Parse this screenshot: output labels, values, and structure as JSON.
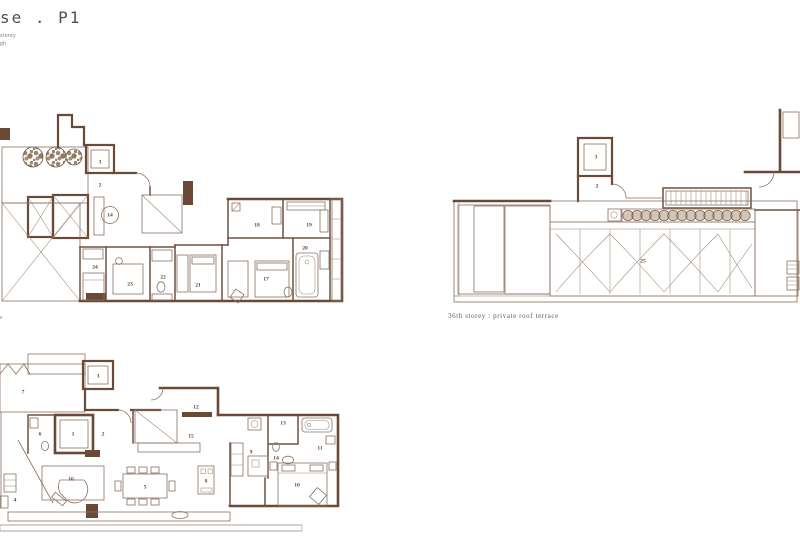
{
  "page": {
    "title_fragment": "se . P1",
    "subtitle_fragment_1": "storey",
    "subtitle_fragment_2": "gh",
    "left_caption_fragment": "e"
  },
  "colors": {
    "wall": "#6a4a37",
    "thin_line": "#8a7160",
    "hatch": "#a28a75",
    "foliage": "#7a5f47",
    "label_text": "#5f4434",
    "title_text": "#4f4f4f",
    "caption_text": "#6b5a4c",
    "background": "#ffffff"
  },
  "plans": {
    "upper_left": {
      "description": "penthouse upper storey floor plan",
      "labels": [
        {
          "x": 100,
          "y": 67,
          "t": "3"
        },
        {
          "x": 100,
          "y": 90,
          "t": "2"
        },
        {
          "x": 110,
          "y": 120,
          "t": "14"
        },
        {
          "x": 95,
          "y": 172,
          "t": "24"
        },
        {
          "x": 130,
          "y": 189,
          "t": "23"
        },
        {
          "x": 163,
          "y": 182,
          "t": "22"
        },
        {
          "x": 198,
          "y": 190,
          "t": "21"
        },
        {
          "x": 266,
          "y": 184,
          "t": "17"
        },
        {
          "x": 257,
          "y": 130,
          "t": "18"
        },
        {
          "x": 309,
          "y": 130,
          "t": "19"
        },
        {
          "x": 305,
          "y": 153,
          "t": "20"
        }
      ]
    },
    "roof": {
      "caption": "36th storey : private roof terrace",
      "labels": [
        {
          "x": 146,
          "y": 51,
          "t": "3"
        },
        {
          "x": 147,
          "y": 80,
          "t": "2"
        },
        {
          "x": 193,
          "y": 155,
          "t": "25"
        }
      ]
    },
    "lower_left": {
      "description": "penthouse main storey floor plan",
      "labels": [
        {
          "x": 23,
          "y": 44,
          "t": "7"
        },
        {
          "x": 98,
          "y": 28,
          "t": "3"
        },
        {
          "x": 73,
          "y": 86,
          "t": "1"
        },
        {
          "x": 103,
          "y": 86,
          "t": "2"
        },
        {
          "x": 40,
          "y": 86,
          "t": "6"
        },
        {
          "x": 196,
          "y": 59,
          "t": "12"
        },
        {
          "x": 191,
          "y": 88,
          "t": "15"
        },
        {
          "x": 251,
          "y": 104,
          "t": "9"
        },
        {
          "x": 283,
          "y": 75,
          "t": "13"
        },
        {
          "x": 276,
          "y": 110,
          "t": "14"
        },
        {
          "x": 320,
          "y": 100,
          "t": "11"
        },
        {
          "x": 297,
          "y": 137,
          "t": "10"
        },
        {
          "x": 71,
          "y": 131,
          "t": "16"
        },
        {
          "x": 145,
          "y": 139,
          "t": "5"
        },
        {
          "x": 206,
          "y": 133,
          "t": "8"
        },
        {
          "x": 15,
          "y": 152,
          "t": "4"
        }
      ]
    }
  }
}
